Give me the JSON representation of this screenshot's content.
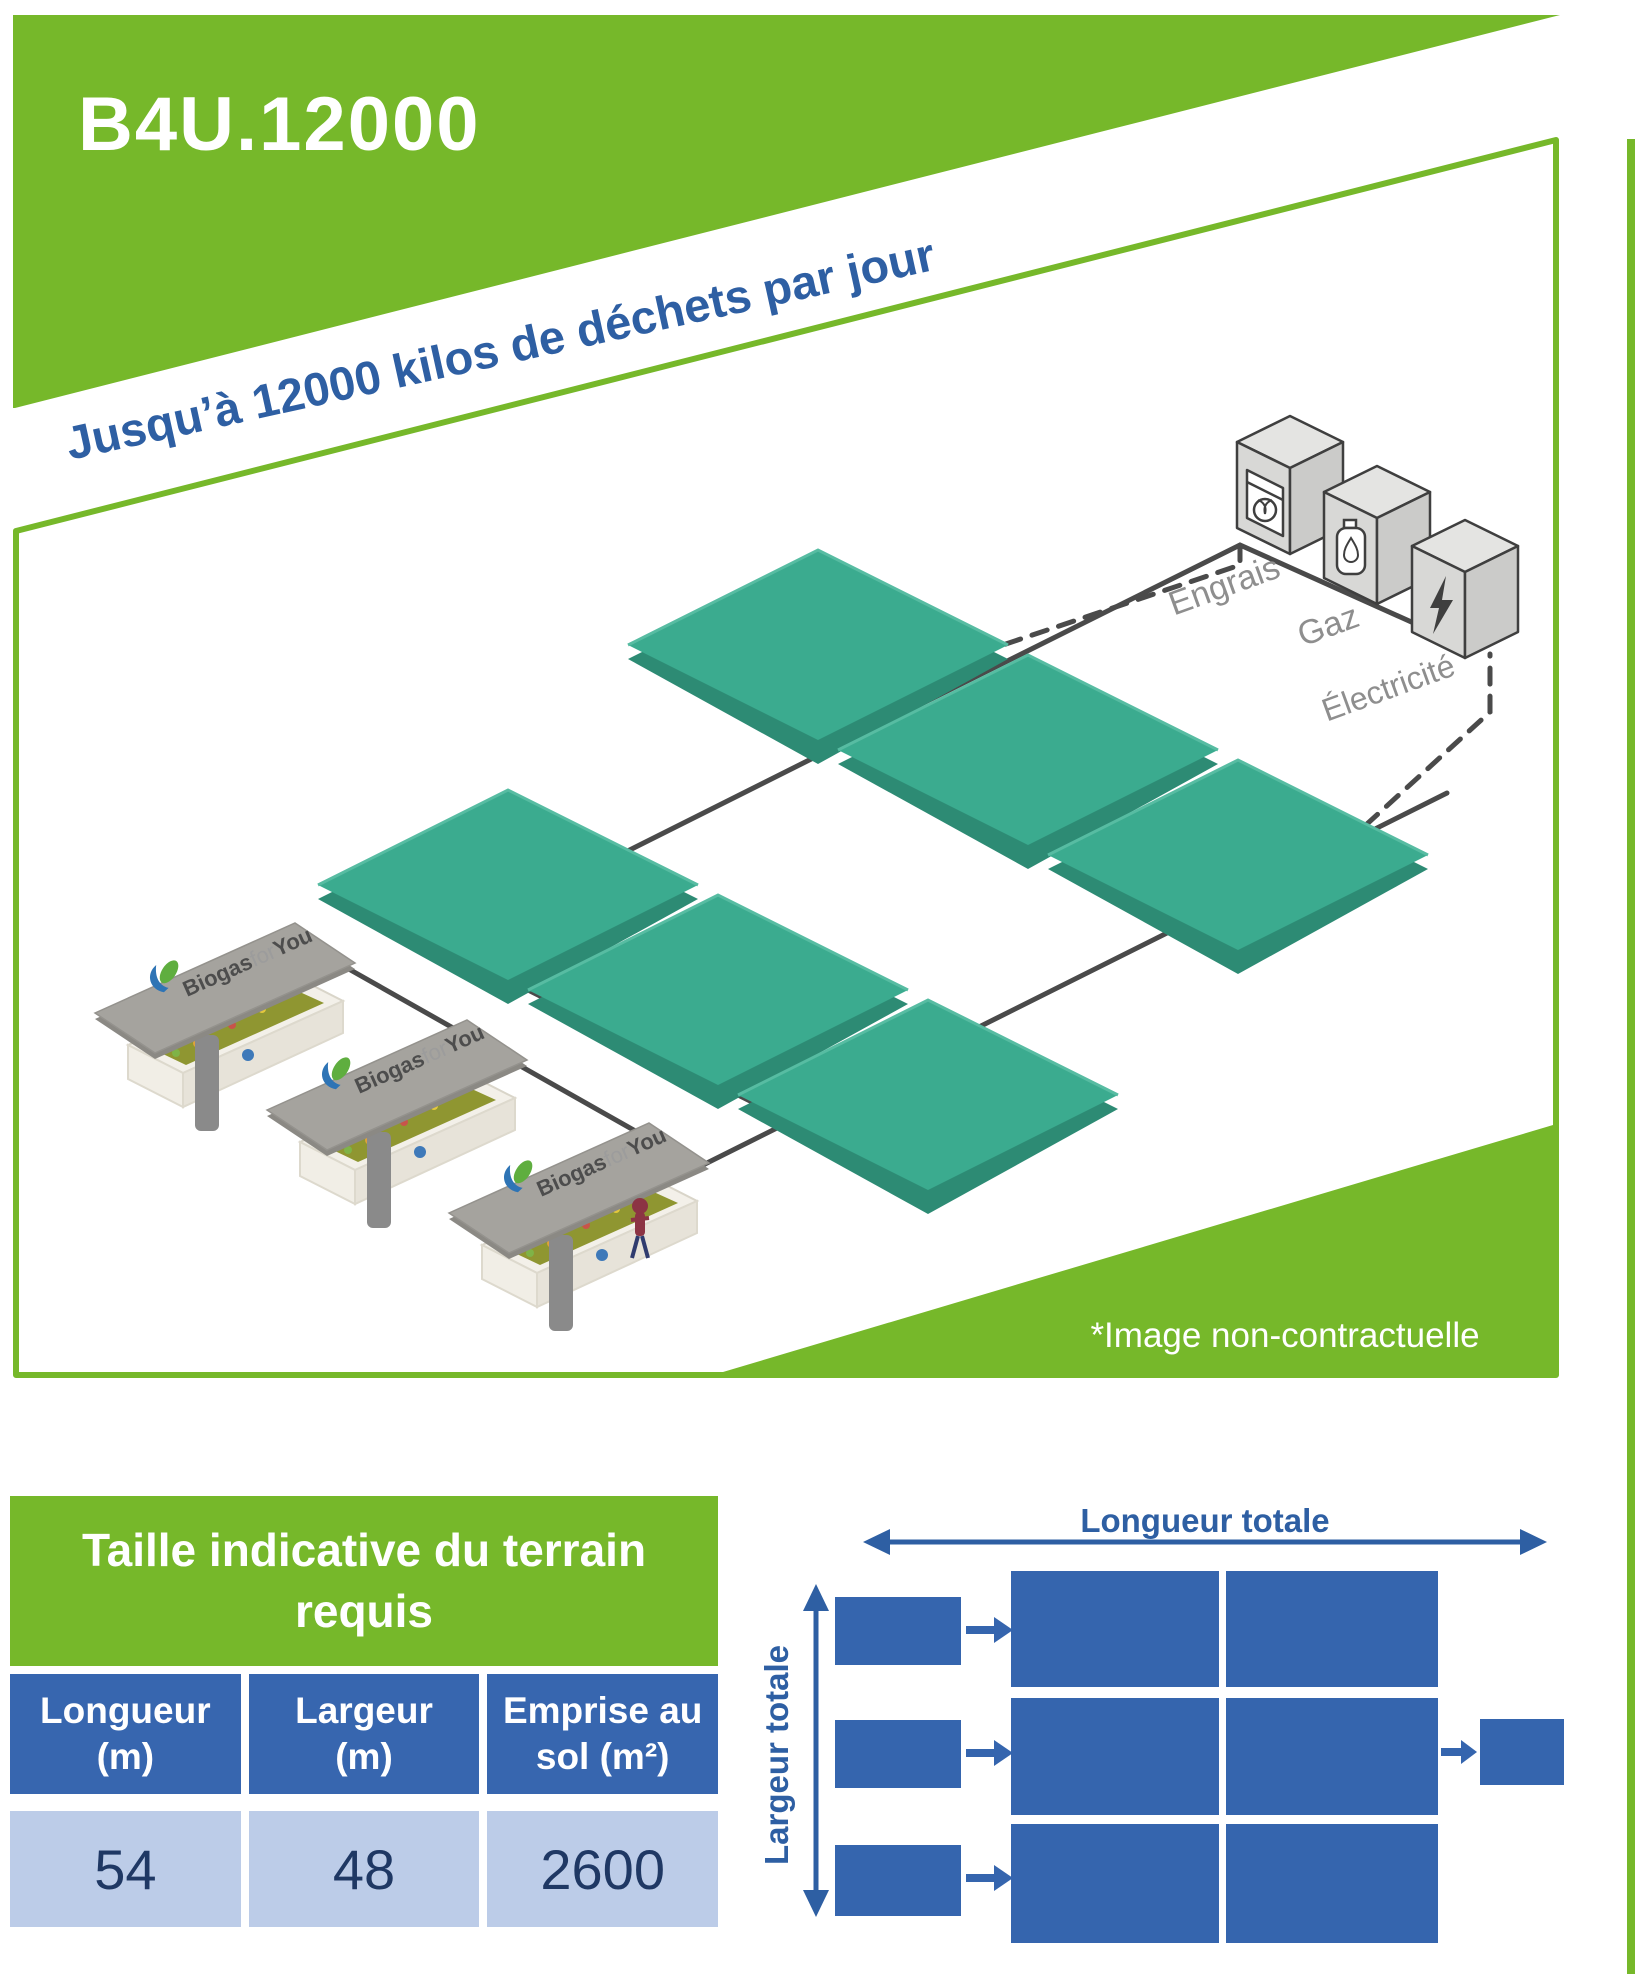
{
  "header": {
    "title": "B4U.12000",
    "tagline": "Jusqu’à 12000 kilos de déchets par jour"
  },
  "illustration": {
    "caption": "*Image non-contractuelle",
    "brand": {
      "b1": "Biogas",
      "b2": "for",
      "b3": "You"
    },
    "outputs": [
      {
        "label": "Engrais"
      },
      {
        "label": "Gaz"
      },
      {
        "label": "Électricité"
      }
    ],
    "digester_count": 6,
    "station_count": 3
  },
  "table": {
    "title": "Taille indicative du terrain requis",
    "columns": [
      {
        "line1": "Longueur",
        "line2": "(m)"
      },
      {
        "line1": "Largeur",
        "line2": "(m)"
      },
      {
        "line1": "Emprise au",
        "line2": "sol (m²)"
      }
    ],
    "values": [
      "54",
      "48",
      "2600"
    ]
  },
  "schematic": {
    "length_label": "Longueur totale",
    "width_label": "Largeur totale"
  },
  "colors": {
    "brand_green": "#76B82A",
    "accent_blue": "#2E5FA3",
    "box_blue": "#3565AE",
    "digester_teal": "#3BAB8F",
    "line_gray": "#4A4A4A"
  }
}
